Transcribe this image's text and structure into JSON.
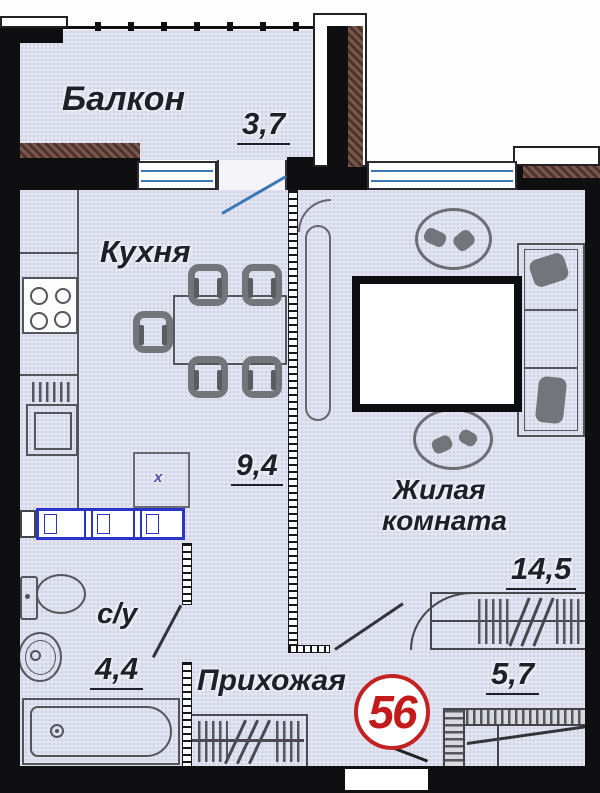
{
  "plan_title": "floor-plan",
  "apartment_number": "56",
  "rooms": {
    "balcony": {
      "label": "Балкон",
      "area": "3,7"
    },
    "kitchen": {
      "label": "Кухня",
      "area": "9,4"
    },
    "living": {
      "line1": "Жилая",
      "line2": "комната",
      "area": "14,5"
    },
    "bathroom": {
      "label": "с/у",
      "area": "4,4"
    },
    "hallway": {
      "label": "Прихожая",
      "area": "5,7"
    }
  },
  "marks": {
    "washer": "х"
  },
  "colors": {
    "floor": "#e2e3f0",
    "wall": "#0f0f12",
    "window_blue": "#3a78b5",
    "closet_blue": "#2a35c8",
    "exterior_hatch": "#7a574c",
    "furniture_gray": "#55555c",
    "accent_red": "#c32222"
  }
}
